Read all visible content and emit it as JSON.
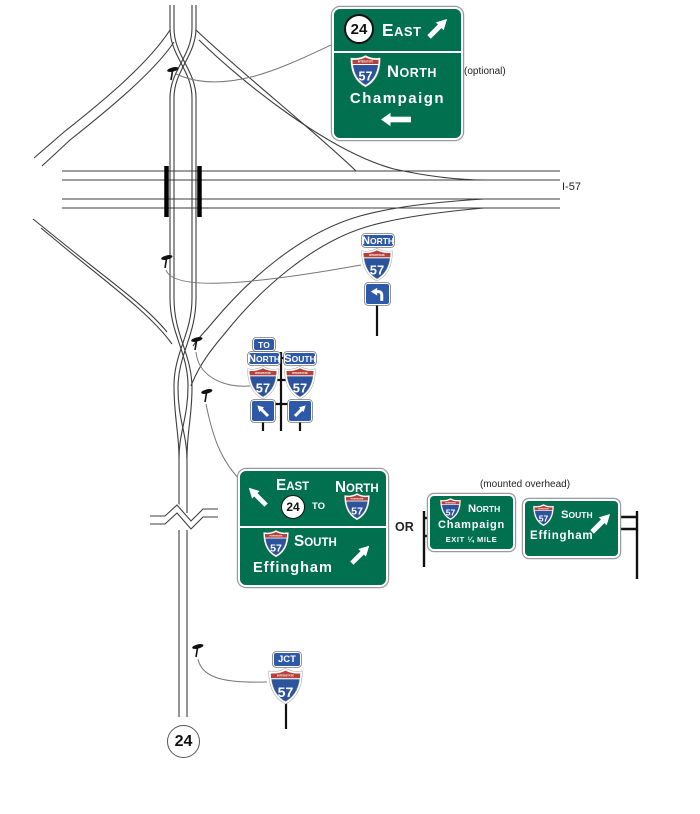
{
  "colors": {
    "sign_green": "#00704F",
    "shield_blue": "#2B549C",
    "shield_red": "#B5413A",
    "plate_blue": "#2E59A8"
  },
  "interstate": {
    "label": "INTERSTATE",
    "number": "57"
  },
  "route24": "24",
  "map_labels": {
    "freeway": "I-57",
    "optional": "(optional)",
    "or": "OR",
    "mounted_overhead": "(mounted overhead)"
  },
  "advance_sign": {
    "east": "EAST",
    "north": "NORTH",
    "champaign": "Champaign"
  },
  "north_assembly": {
    "north": "NORTH"
  },
  "to_assembly": {
    "to": "TO",
    "north": "NORTH",
    "south": "SOUTH"
  },
  "junction_sign": {
    "east": "EAST",
    "to": "TO",
    "north": "NORTH",
    "south": "SOUTH",
    "effingham": "Effingham"
  },
  "overhead_signs": {
    "north": "NORTH",
    "champaign": "Champaign",
    "exit_line": "EXIT ¼ MILE",
    "south": "SOUTH",
    "effingham": "Effingham"
  },
  "jct_assembly": {
    "jct": "JCT"
  }
}
